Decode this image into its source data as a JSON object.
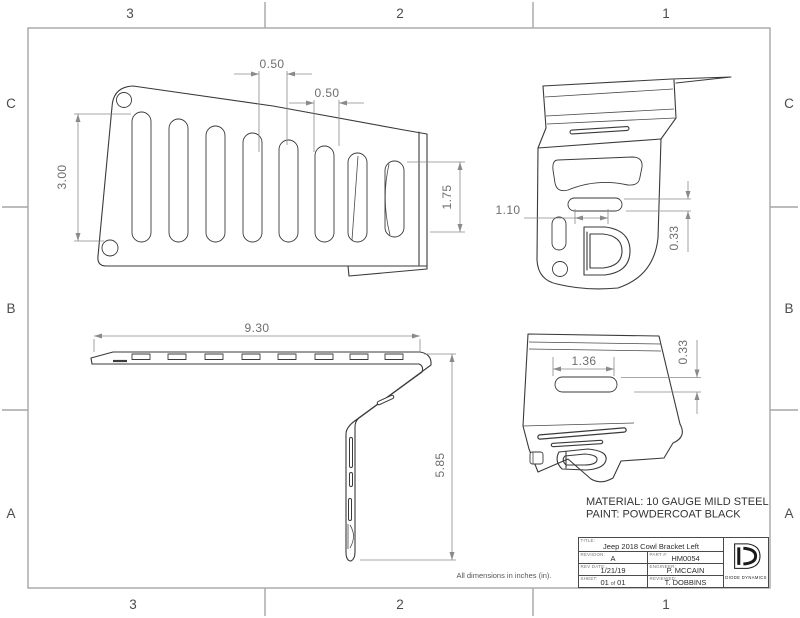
{
  "colors": {
    "drawing_line": "#3a3a3a",
    "dimension_line": "#8a8a8a",
    "frame": "#a6a6a6",
    "background": "#ffffff"
  },
  "zones": {
    "columns": [
      "3",
      "2",
      "1"
    ],
    "rows": [
      "C",
      "B",
      "A"
    ]
  },
  "dimensions": {
    "front_slot_pitch_a": "0.50",
    "front_slot_pitch_b": "0.50",
    "front_slot_length": "3.00",
    "front_short_slot_length": "1.75",
    "side_slot_width": "1.10",
    "side_slot_height": "0.33",
    "top_overall_length": "9.30",
    "top_overall_depth": "5.85",
    "rear_slot_width": "1.36",
    "rear_slot_height": "0.33"
  },
  "notes": {
    "material": "MATERIAL: 10 GAUGE MILD STEEL",
    "paint": "PAINT: POWDERCOAT BLACK",
    "units": "All dimensions in inches (in)."
  },
  "title_block": {
    "title_label": "TITLE:",
    "title": "Jeep 2018 Cowl Bracket Left",
    "revision_label": "REVISION:",
    "revision": "A",
    "part_label": "PART #:",
    "part_number": "HM0054",
    "rev_date_label": "REV DATE:",
    "rev_date": "1/21/19",
    "engineer_label": "ENGINEER:",
    "engineer": "P. MCCAIN",
    "sheet_label": "SHEET:",
    "sheet_current": "01",
    "sheet_of": "of",
    "sheet_total": "01",
    "reviewed_label": "REVIEWED:",
    "reviewed": "T. DOBBINS",
    "company": "DIODE DYNAMICS"
  }
}
